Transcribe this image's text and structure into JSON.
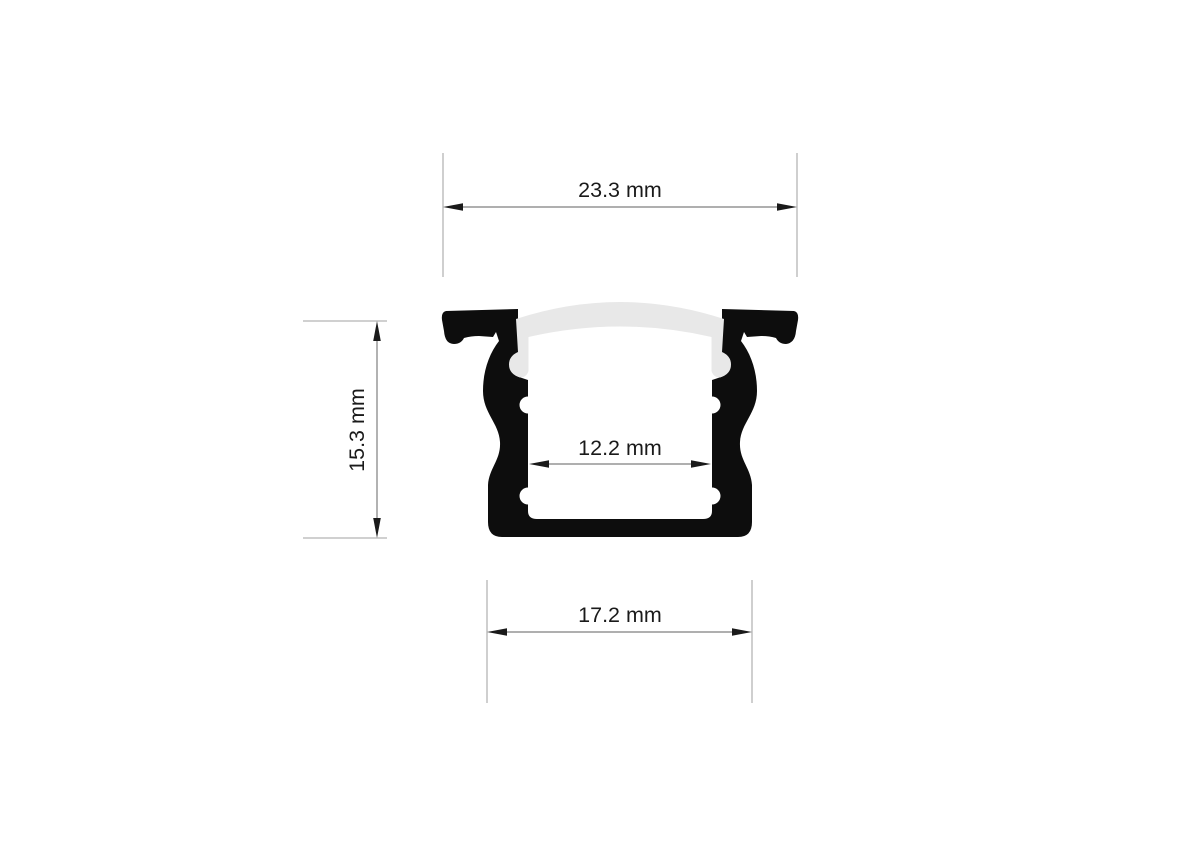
{
  "drawing": {
    "name": "led-aluminium-profile-cross-section"
  },
  "colors": {
    "profile": "#0d0d0d",
    "diffuser": "#e8e8e8",
    "background": "#ffffff",
    "dim_line": "#7f7f7f",
    "ext_line": "#b5b5b5",
    "arrow": "#1a1a1a",
    "text": "#1a1a1a"
  },
  "dimensions": {
    "overall_width": {
      "label": "23.3 mm",
      "value": 23.3,
      "unit": "mm"
    },
    "height": {
      "label": "15.3 mm",
      "value": 15.3,
      "unit": "mm"
    },
    "inner_width": {
      "label": "12.2 mm",
      "value": 12.2,
      "unit": "mm"
    },
    "base_width": {
      "label": "17.2 mm",
      "value": 17.2,
      "unit": "mm"
    }
  }
}
